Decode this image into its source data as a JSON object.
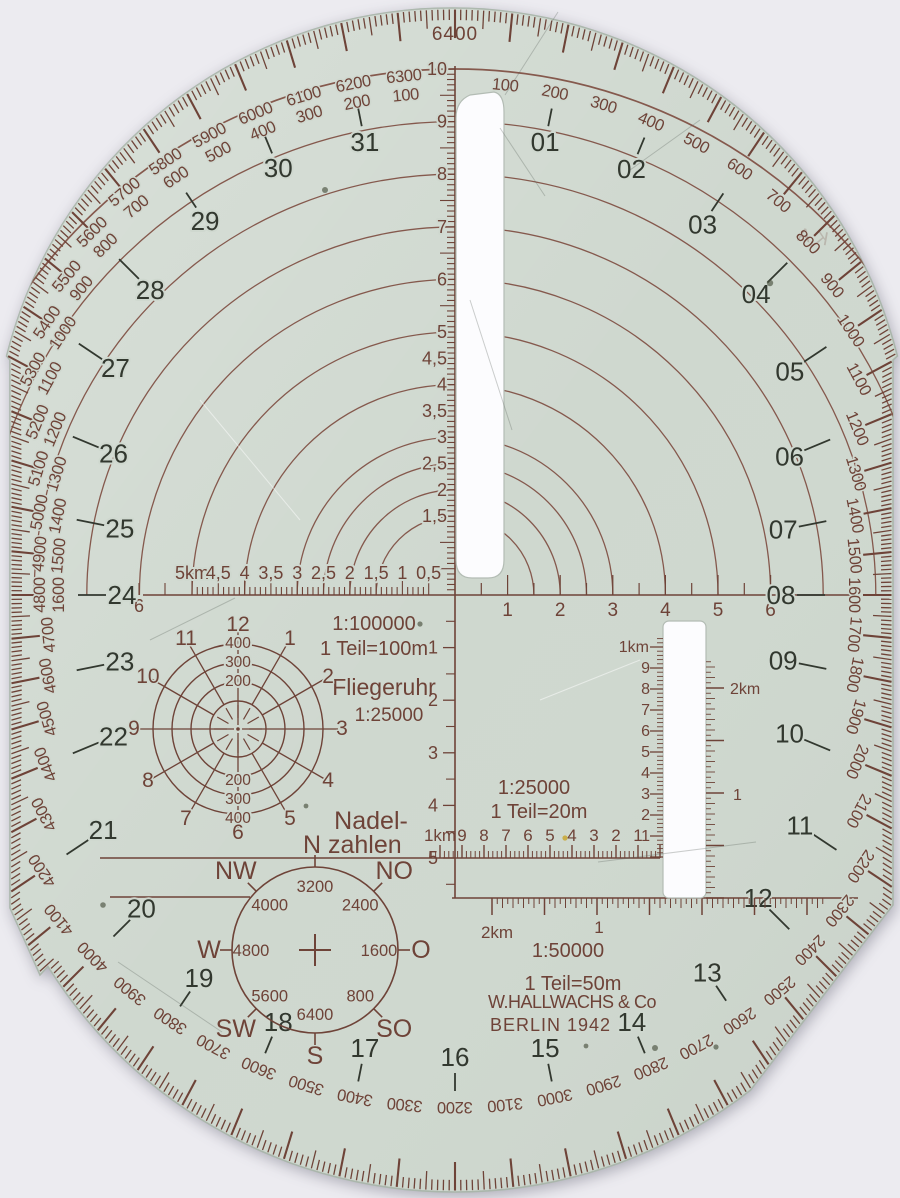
{
  "maker": {
    "line1": "W.HALLWACHS & Co",
    "line2": "BERLIN 1942",
    "stamp": "K.A"
  },
  "colors": {
    "background": "#ecebf0",
    "plate": "#cfd8cf",
    "plate_edge": "#aab6ab",
    "ink": "#6e4338",
    "ink_light": "#7c4a3e",
    "black": "#32382f",
    "slot_white": "#fcfcfe"
  },
  "mil_ring": {
    "top_label": "6400",
    "big_numbers": [
      "01",
      "02",
      "03",
      "04",
      "05",
      "06",
      "07",
      "08",
      "09",
      "10",
      "11",
      "12",
      "13",
      "14",
      "15",
      "16",
      "17",
      "18",
      "19",
      "20",
      "21",
      "22",
      "23",
      "24",
      "25",
      "26",
      "27",
      "28",
      "29",
      "30",
      "31"
    ],
    "upper_right_labels": [
      "100",
      "200",
      "300",
      "400",
      "500",
      "600",
      "700",
      "800",
      "900",
      "1000",
      "1100",
      "1200",
      "1300",
      "1400",
      "1500"
    ],
    "right_edge_label": "1600",
    "upper_left_pairs": [
      [
        "6300",
        "100"
      ],
      [
        "6200",
        "200"
      ],
      [
        "6100",
        "300"
      ],
      [
        "6000",
        "400"
      ],
      [
        "5900",
        "500"
      ],
      [
        "5800",
        "600"
      ],
      [
        "5700",
        "700"
      ],
      [
        "5600",
        "800"
      ],
      [
        "5500",
        "900"
      ],
      [
        "5400",
        "1000"
      ],
      [
        "5300",
        "1100"
      ],
      [
        "5200",
        "1200"
      ],
      [
        "5100",
        "1300"
      ],
      [
        "5000",
        "1400"
      ],
      [
        "4900",
        "1500"
      ]
    ],
    "left_edge_pair": [
      "4800",
      "1600"
    ],
    "lower_labels": [
      "1700",
      "1800",
      "1900",
      "2000",
      "2100",
      "2200",
      "2300",
      "2400",
      "2500",
      "2600",
      "2700",
      "2800",
      "2900",
      "3000",
      "3100",
      "3200",
      "3300",
      "3400",
      "3500",
      "3600",
      "3700",
      "3800",
      "3900",
      "4000",
      "4100",
      "4200",
      "4300",
      "4400",
      "4500",
      "4600",
      "4700"
    ]
  },
  "vertical_scale": {
    "above_labels": [
      "10",
      "9",
      "8",
      "7",
      "6",
      "5",
      "4,5",
      "4",
      "3,5",
      "3",
      "2,5",
      "2",
      "1,5"
    ],
    "below_labels": [
      "1",
      "2",
      "3",
      "4",
      "5"
    ]
  },
  "horizontal_scale": {
    "left_labels": [
      "5km",
      "4,5",
      "4",
      "3,5",
      "3",
      "2,5",
      "2",
      "1,5",
      "1",
      "0,5"
    ],
    "left_end_label": "6",
    "right_labels": [
      "1",
      "2",
      "3",
      "4",
      "5",
      "6"
    ]
  },
  "ruler_100000": {
    "title": "1:100000",
    "subtitle": "1 Teil=100m"
  },
  "fliegeruhr": {
    "title": "Fliegeruhr",
    "scale": "1:25000",
    "ring_labels": [
      "200",
      "300",
      "400"
    ],
    "clock_numbers": [
      "1",
      "2",
      "3",
      "4",
      "5",
      "6",
      "7",
      "8",
      "9",
      "10",
      "11",
      "12"
    ]
  },
  "ruler_25000": {
    "title": "1:25000",
    "subtitle": "1 Teil=20m",
    "labels": [
      "1km",
      "9",
      "8",
      "7",
      "6",
      "5",
      "4",
      "3",
      "2",
      "1"
    ]
  },
  "ruler_50000": {
    "title": "1:50000",
    "subtitle": "1 Teil=50m",
    "label_2km": "2km",
    "label_1": "1"
  },
  "slot_scales": {
    "left": {
      "top": "1km",
      "numbers": [
        "9",
        "8",
        "7",
        "6",
        "5",
        "4",
        "3",
        "2",
        "1"
      ]
    },
    "right": {
      "top": "2km",
      "mid": "1"
    }
  },
  "nadelzahlen": {
    "title_line1": "Nadel-",
    "title_line2": "N zahlen",
    "values": [
      {
        "deg": 0,
        "v": "3200"
      },
      {
        "deg": 45,
        "v": "2400"
      },
      {
        "deg": 90,
        "v": "1600"
      },
      {
        "deg": 135,
        "v": "800"
      },
      {
        "deg": 180,
        "v": "6400"
      },
      {
        "deg": 225,
        "v": "5600"
      },
      {
        "deg": 270,
        "v": "4800"
      },
      {
        "deg": 315,
        "v": "4000"
      }
    ],
    "directions": [
      {
        "deg": 45,
        "label": "NO"
      },
      {
        "deg": 90,
        "label": "O"
      },
      {
        "deg": 135,
        "label": "SO"
      },
      {
        "deg": 180,
        "label": "S"
      },
      {
        "deg": 225,
        "label": "SW"
      },
      {
        "deg": 270,
        "label": "W"
      },
      {
        "deg": 315,
        "label": "NW"
      }
    ]
  }
}
